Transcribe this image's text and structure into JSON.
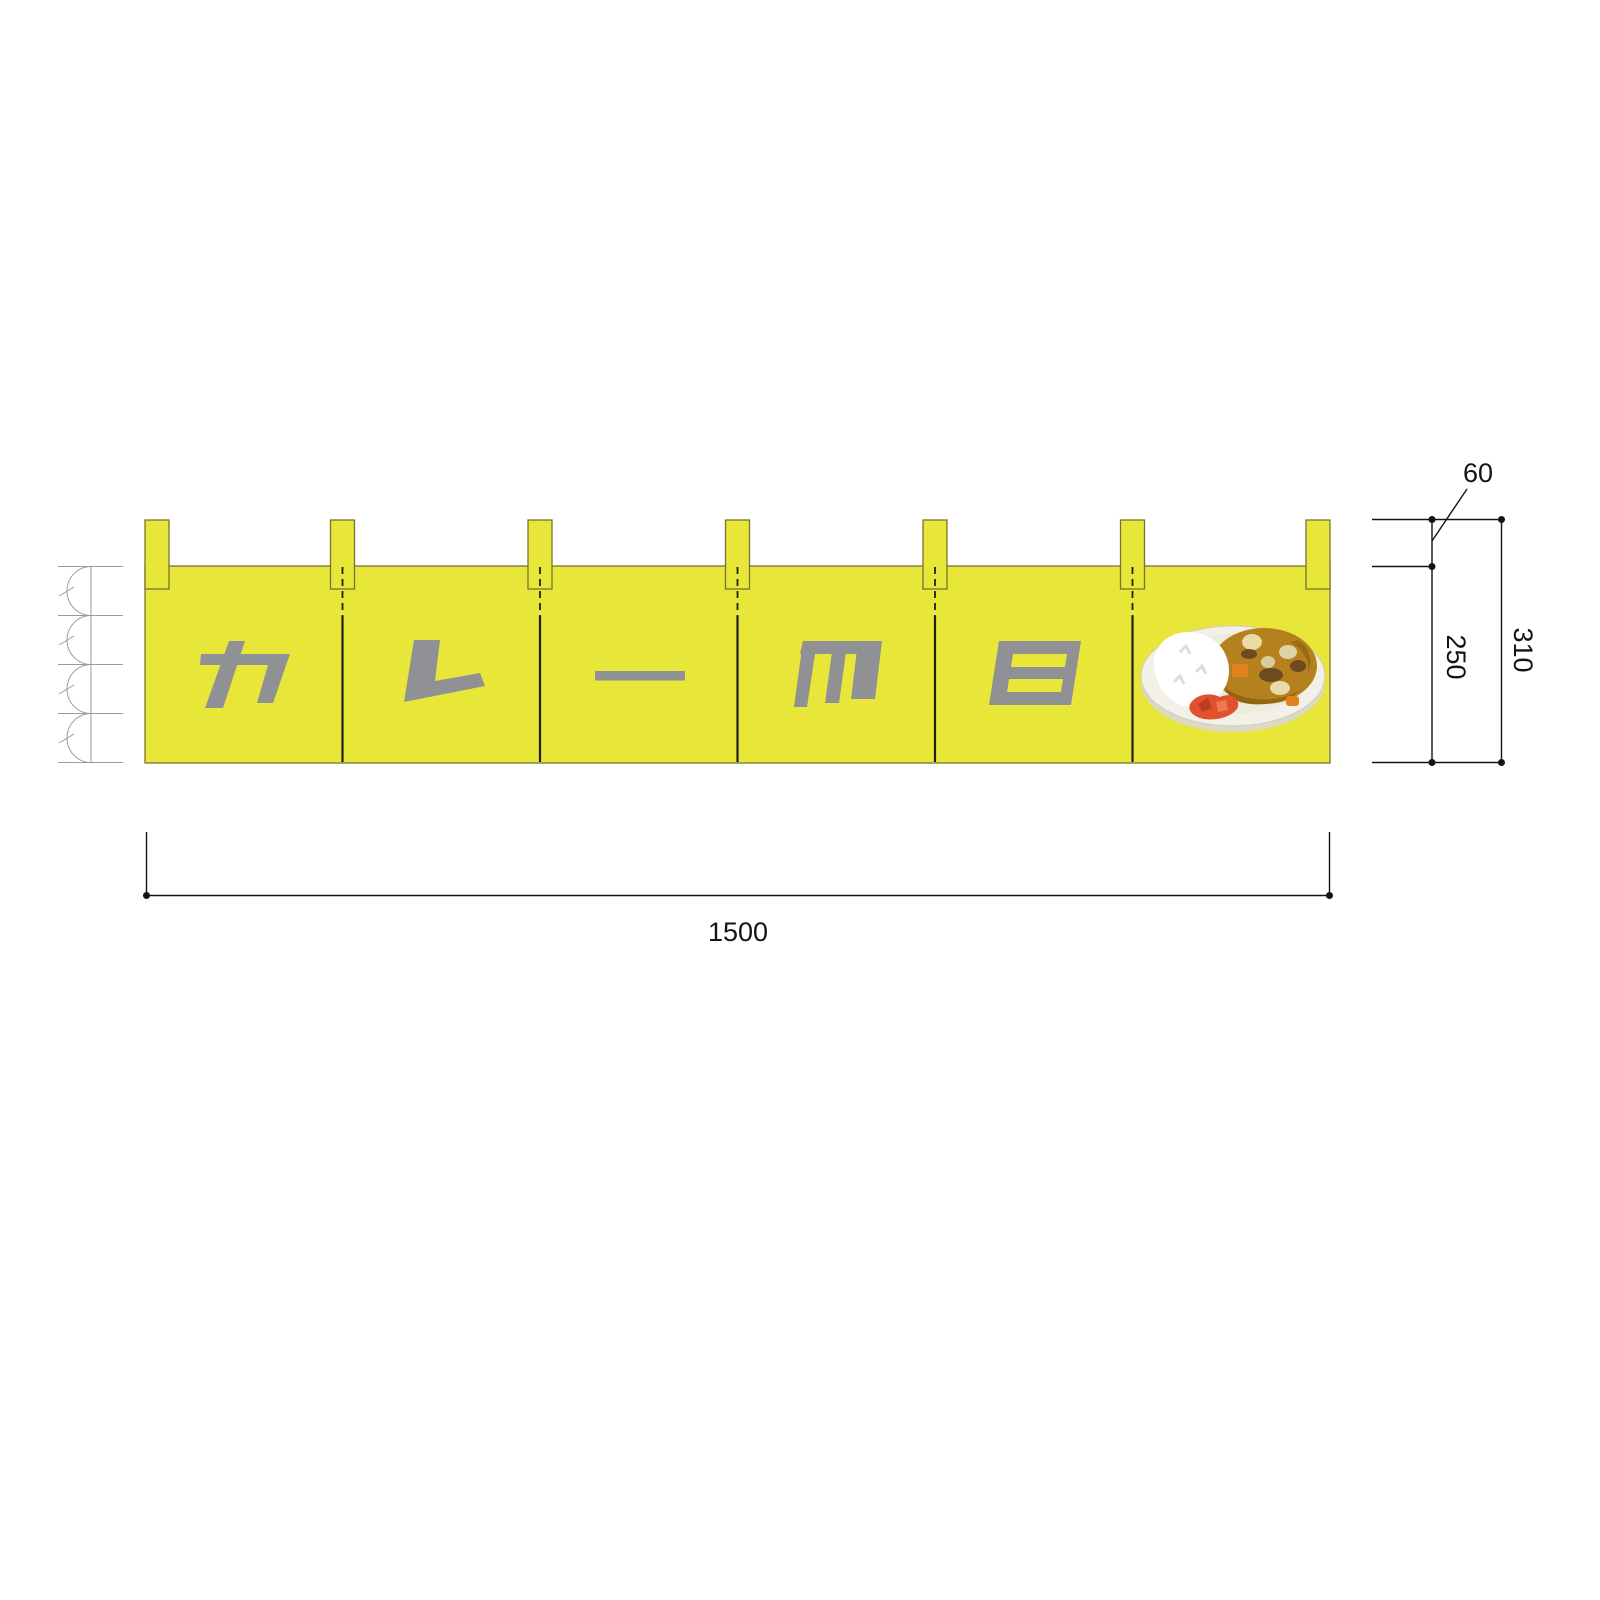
{
  "noren": {
    "banner_text": "カレーの日",
    "characters": [
      "カ",
      "レ",
      "ー",
      "の",
      "日"
    ],
    "panel_count": 6,
    "tab_count": 7,
    "illustration": "curry-rice-plate",
    "colors": {
      "fabric": "#e9e63a",
      "outline": "#75752f",
      "lettering": "#8f9194"
    }
  },
  "dimensions": {
    "width": "1500",
    "body_height": "250",
    "total_height": "310",
    "tab_height": "60"
  },
  "equal_division_symbol": {
    "arc_count": 4
  }
}
